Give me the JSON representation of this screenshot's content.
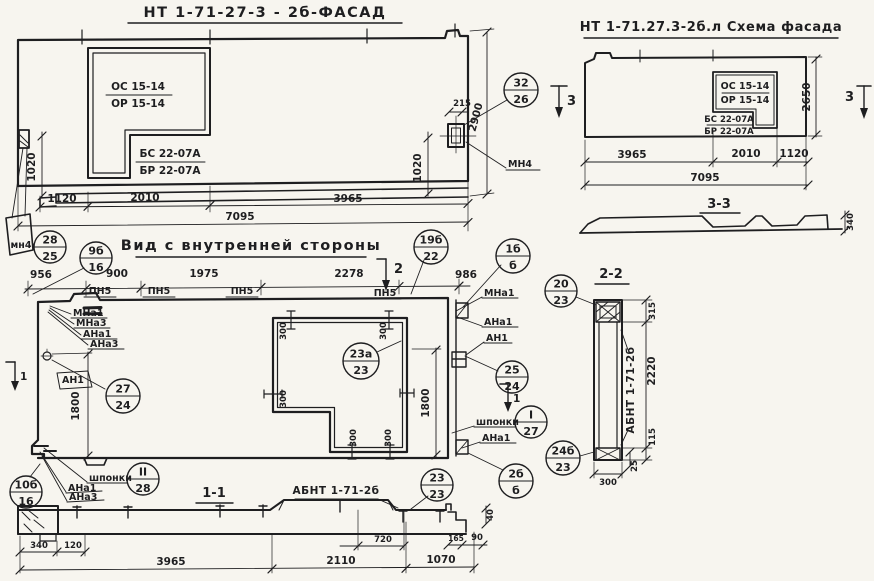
{
  "window_labels": {
    "os": "ОС 15-14",
    "or": "ОР 15-14",
    "bs": "БС 22-07А",
    "br": "БР 22-07А"
  },
  "facade": {
    "title": "НТ 1-71-27-3 - 2б-ФАСАД",
    "dim_1120": "1120",
    "dim_2010": "2010",
    "dim_3965": "3965",
    "dim_7095": "7095",
    "dim_1020": "1020",
    "dim_215": "215",
    "dim_2900": "2900",
    "label_mn4_small": "мн4",
    "label_mn4": "МН4"
  },
  "schema": {
    "title": "НТ 1-71.27.3-2б.л Схема фасада",
    "dim_3965": "3965",
    "dim_2010": "2010",
    "dim_1120": "1120",
    "dim_7095": "7095",
    "dim_2650": "2650",
    "section_label": "3-3",
    "dim_340": "340"
  },
  "view": {
    "title": "Вид с внутренней стороны",
    "dim_956": "956",
    "dim_900": "900",
    "dim_1975": "1975",
    "dim_2278": "2278",
    "dim_986": "986",
    "label_pn5": "ПН5",
    "label_mna1": "МНа1",
    "label_mna3": "МНа3",
    "label_ana1": "АНа1",
    "label_ana3": "АНа3",
    "label_an1": "АН1",
    "label_shponki": "шпонки",
    "dim_1800": "1800",
    "dim_300": "300"
  },
  "section11": {
    "label": "1-1",
    "label_abnt": "АБНТ 1-71-2б",
    "dim_340": "340",
    "dim_120": "120",
    "dim_3965": "3965",
    "dim_720": "720",
    "dim_2110": "2110",
    "dim_1070": "1070",
    "dim_165": "165",
    "dim_90": "90",
    "dim_40": "40"
  },
  "section22": {
    "label": "2-2",
    "label_abnt": "АБНТ 1-71-2б",
    "dim_315": "315",
    "dim_2220": "2220",
    "dim_115": "115",
    "dim_25": "25",
    "dim_300": "300"
  },
  "markers": {
    "m1": "1",
    "m2": "2",
    "m3": "3"
  },
  "callouts": {
    "c32_26": {
      "top": "32",
      "bot": "26"
    },
    "c28_25": {
      "top": "28",
      "bot": "25"
    },
    "c9b_16": {
      "top": "9б",
      "bot": "16"
    },
    "c19b_22": {
      "top": "19б",
      "bot": "22"
    },
    "c1b_b": {
      "top": "1б",
      "bot": "б"
    },
    "c20_23": {
      "top": "20",
      "bot": "23"
    },
    "c23a_23": {
      "top": "23а",
      "bot": "23"
    },
    "c27_24": {
      "top": "27",
      "bot": "24"
    },
    "c25_24": {
      "top": "25",
      "bot": "24"
    },
    "cI_27": {
      "top": "I",
      "bot": "27"
    },
    "cII_28": {
      "top": "II",
      "bot": "28"
    },
    "c2b_b": {
      "top": "2б",
      "bot": "б"
    },
    "c24b_23": {
      "top": "24б",
      "bot": "23"
    },
    "c10b_16": {
      "top": "10б",
      "bot": "16"
    },
    "c23_23": {
      "top": "23",
      "bot": "23"
    }
  },
  "colors": {
    "ink": "#1e1e20",
    "paper": "#f7f5ef"
  }
}
